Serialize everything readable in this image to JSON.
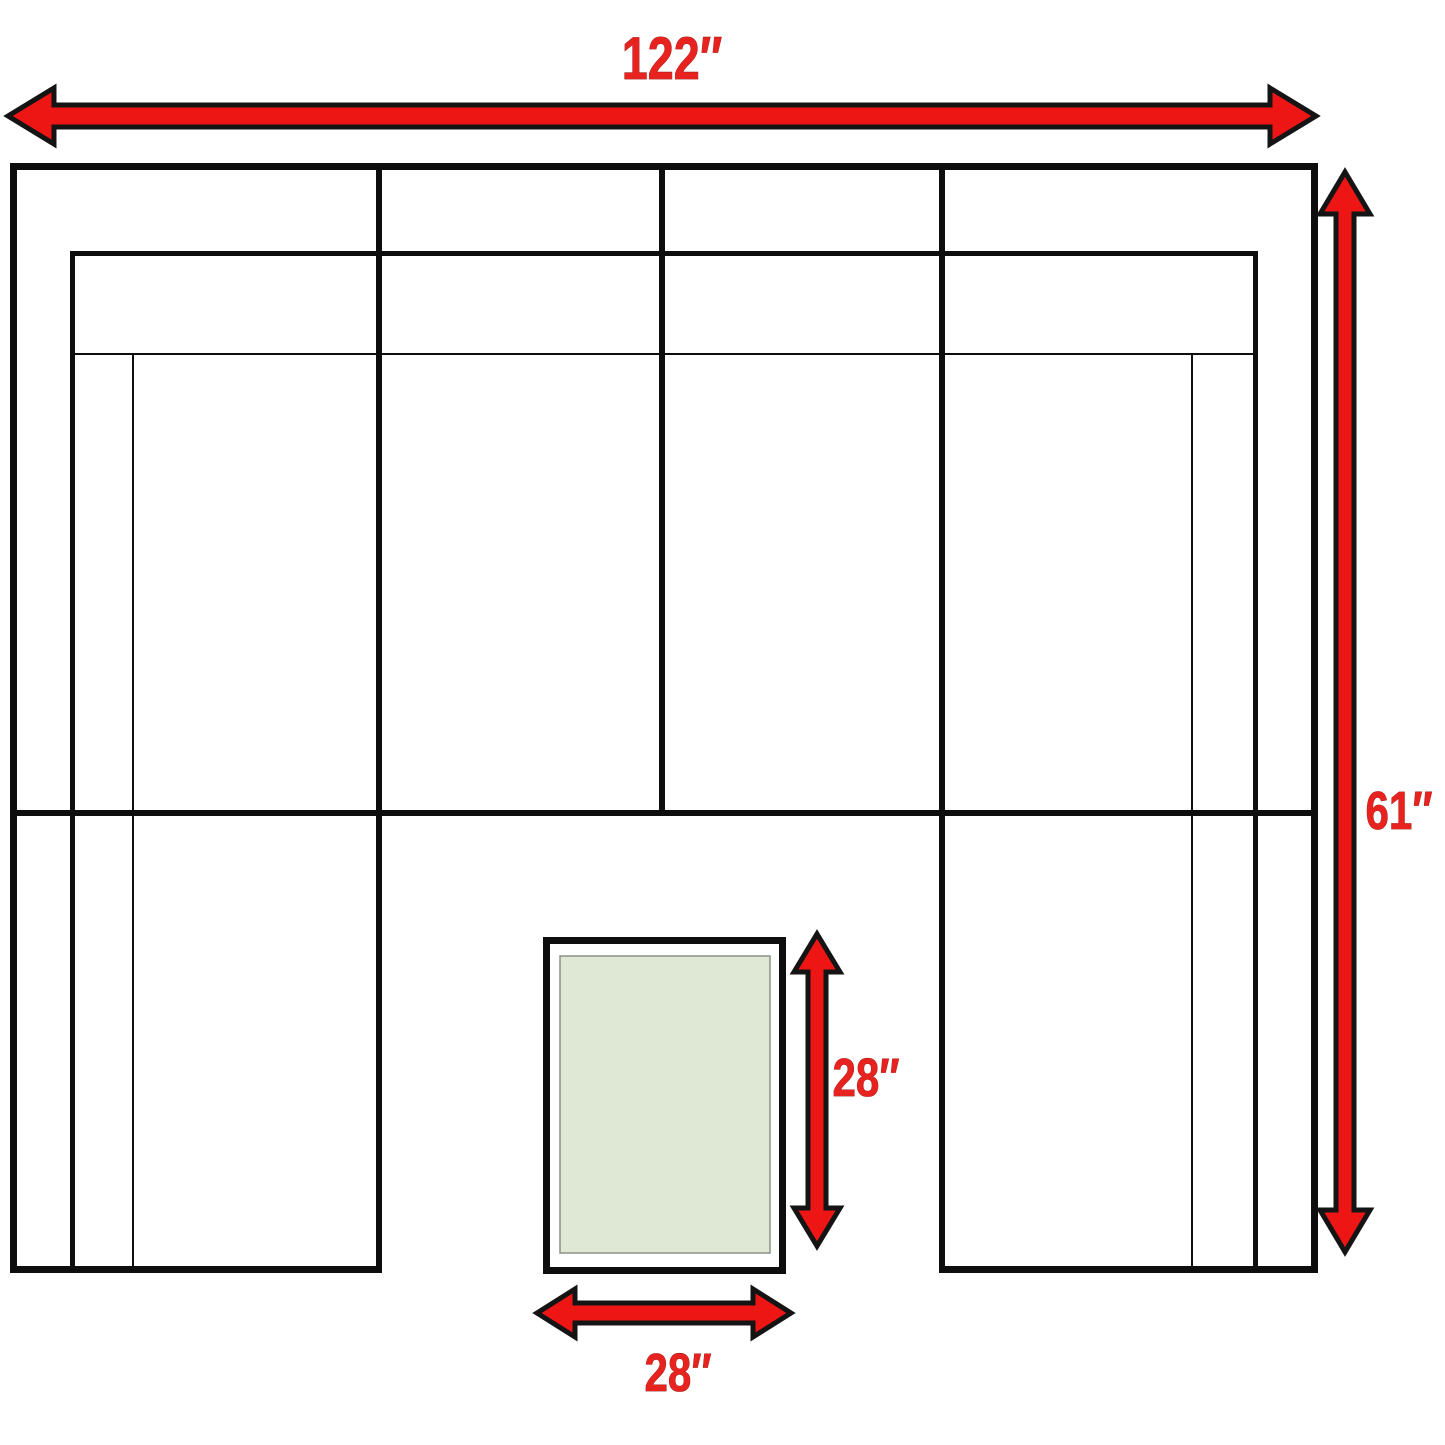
{
  "diagram": {
    "measurements": {
      "overall_width": {
        "label": "122″",
        "inches": 122
      },
      "overall_depth": {
        "label": "61″",
        "inches": 61
      },
      "ottoman_depth": {
        "label": "28″",
        "inches": 28
      },
      "ottoman_width": {
        "label": "28″",
        "inches": 28
      }
    },
    "colors": {
      "arrow_fill": "#ee1515",
      "arrow_outline": "#141414",
      "label_text": "#e8221e",
      "sofa_outline": "#0e0e0e",
      "ottoman_fill": "#dee8d4",
      "ottoman_inner_border": "#8a9087",
      "background": "#ffffff"
    }
  }
}
